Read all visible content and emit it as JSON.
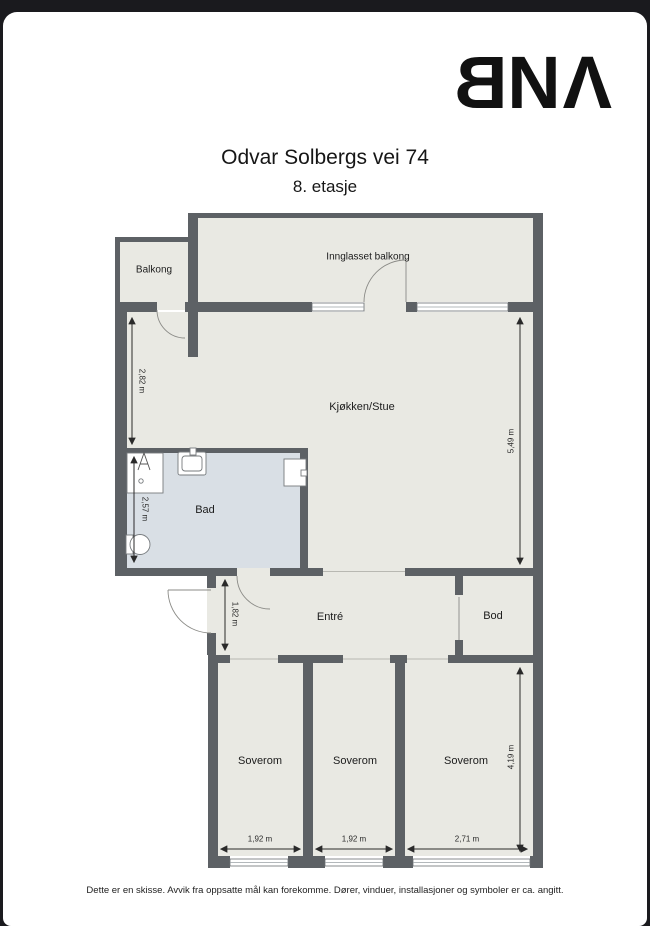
{
  "colors": {
    "frame": "#1a1a1e",
    "wall": "#5d6165",
    "floor": "#e9e9e3",
    "bathroom_floor": "#d9dfe5",
    "logo": "#111111"
  },
  "header": {
    "logo": {
      "b": "B",
      "n": "N",
      "a": "Λ"
    },
    "title": "Odvar Solbergs vei 74",
    "subtitle": "8. etasje"
  },
  "rooms": {
    "balkong": {
      "label": "Balkong"
    },
    "innglasset_balkong": {
      "label": "Innglasset balkong"
    },
    "kjokken_stue": {
      "label": "Kjøkken/Stue"
    },
    "bad": {
      "label": "Bad"
    },
    "entre": {
      "label": "Entré"
    },
    "bod": {
      "label": "Bod"
    },
    "soverom_1": {
      "label": "Soverom"
    },
    "soverom_2": {
      "label": "Soverom"
    },
    "soverom_3": {
      "label": "Soverom"
    }
  },
  "measurements": {
    "kjokken_left_height": "2,82 m",
    "kjokken_right_height": "5,49 m",
    "bad_height": "2,57 m",
    "entre_height": "1,82 m",
    "soverom_3_height": "4,19 m",
    "soverom_1_width": "1,92 m",
    "soverom_2_width": "1,92 m",
    "soverom_3_width": "2,71 m"
  },
  "footer": {
    "disclaimer": "Dette er en skisse. Avvik fra oppsatte mål kan forekomme. Dører, vinduer, installasjoner og symboler er ca. angitt."
  }
}
